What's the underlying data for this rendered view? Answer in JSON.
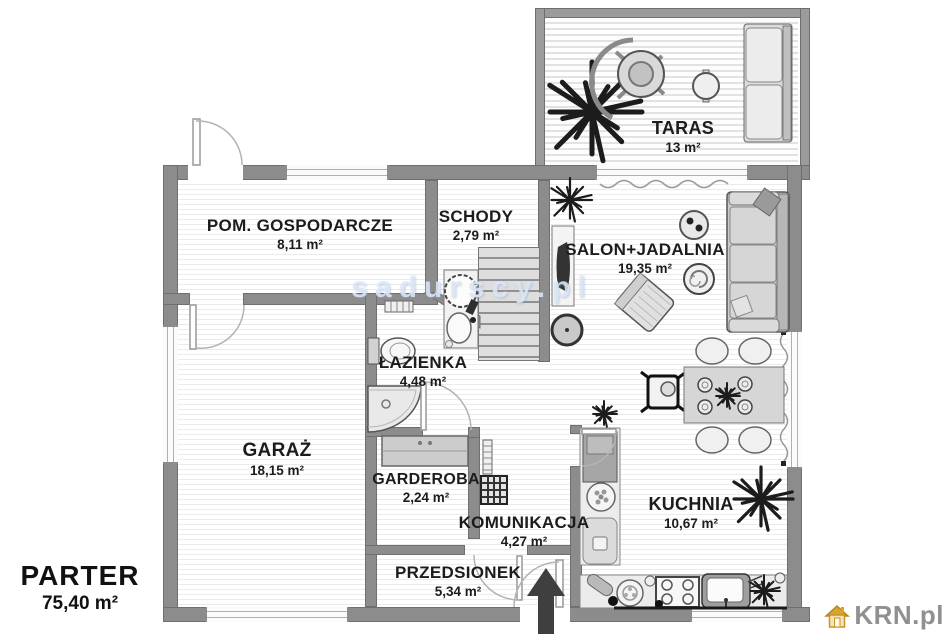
{
  "plan": {
    "floor": {
      "label": "PARTER",
      "area": "75,40 m²"
    },
    "watermark": "sadurscy.pl",
    "brand": {
      "name": "KRN.pl"
    },
    "rooms": {
      "taras": {
        "name": "TARAS",
        "area": "13 m²"
      },
      "pom_gospodarcze": {
        "name": "POM. GOSPODARCZE",
        "area": "8,11 m²"
      },
      "schody": {
        "name": "SCHODY",
        "area": "2,79 m²"
      },
      "salon_jadalnia": {
        "name": "SALON+JADALNIA",
        "area": "19,35 m²"
      },
      "lazienka": {
        "name": "ŁAZIENKA",
        "area": "4,48 m²"
      },
      "garaz": {
        "name": "GARAŻ",
        "area": "18,15 m²"
      },
      "garderoba": {
        "name": "GARDEROBA",
        "area": "2,24 m²"
      },
      "komunikacja": {
        "name": "KOMUNIKACJA",
        "area": "4,27 m²"
      },
      "kuchnia": {
        "name": "KUCHNIA",
        "area": "10,67 m²"
      },
      "przedsionek": {
        "name": "PRZEDSIONEK",
        "area": "5,34 m²"
      }
    },
    "colors": {
      "wall": "#8c8c8c",
      "logo_gold": "#d9a52e",
      "logo_text": "#909090",
      "label_text": "#1c1c1c"
    }
  }
}
